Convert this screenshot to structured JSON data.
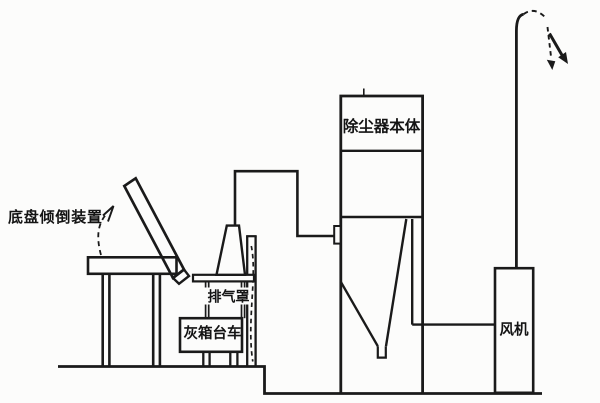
{
  "diagram": {
    "title": "ash-handling and dust-collection system schematic",
    "labels": {
      "tipping_device": "底盘倾倒装置",
      "exhaust_hood": "排气罩",
      "ash_trolley": "灰箱台车",
      "dust_collector": "除尘器本体",
      "fan": "风机"
    },
    "colors": {
      "ink": "#1a1a1a",
      "paper": "#fcfcfb"
    }
  }
}
